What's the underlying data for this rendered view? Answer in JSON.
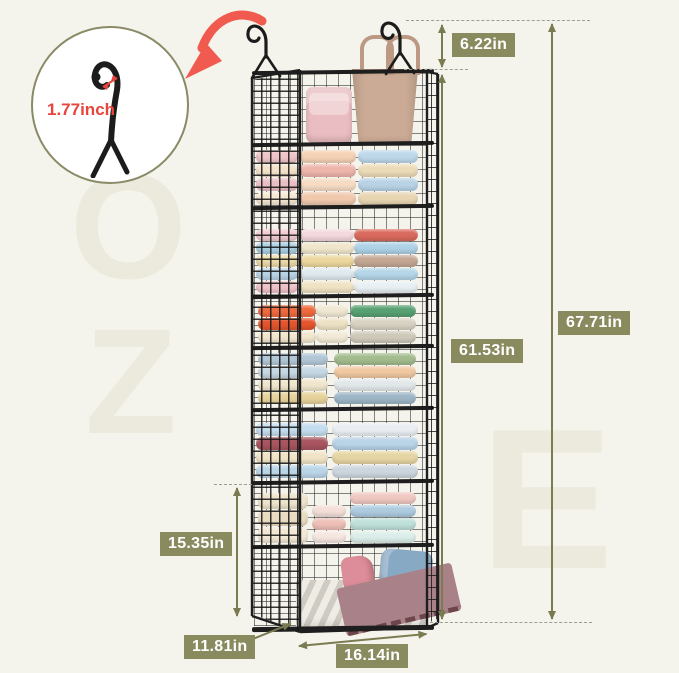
{
  "scene": {
    "background": "#f5f4ec"
  },
  "watermark": {
    "letters": [
      "O",
      "Z",
      "E"
    ]
  },
  "inset": {
    "label": "1.77inch",
    "label_color": "#e8453c",
    "circle_border": "#8a8a66",
    "icon": "hanging-hook"
  },
  "dimensions": {
    "badge_color": "#8a8a5f",
    "line_color": "#7b7b52",
    "dash_color": "#9d9d90",
    "hook_to_top": "6.22in",
    "shelving_height": "61.53in",
    "total_height": "67.71in",
    "lower_section_height": "15.35in",
    "depth": "11.81in",
    "width": "16.14in"
  },
  "callout": {
    "arrow_color": "#f15a4f"
  },
  "organizer": {
    "wire_color": "#1e1e1e",
    "hooks": [
      "hanging-hook-left",
      "hanging-hook-right"
    ],
    "top_items": [
      {
        "name": "pink-quilted-handbag",
        "color": "#e9bdc1"
      },
      {
        "name": "tan-tote-bag",
        "color": "#cbab95",
        "handle_color": "#bb9983"
      }
    ],
    "shelves": [
      {
        "contents": "folded-clothes",
        "bottom_y": 205,
        "stacks": [
          {
            "x": 2,
            "w": 42,
            "lh": 13,
            "layers": [
              "#efc5c8",
              "#f2e2c9",
              "#eabfc3",
              "#f5e8d2"
            ]
          },
          {
            "x": 46,
            "w": 56,
            "lh": 13,
            "layers": [
              "#f4d2b5",
              "#eeb5ab",
              "#f6dcc3",
              "#f0c9ad"
            ]
          },
          {
            "x": 104,
            "w": 60,
            "lh": 13,
            "layers": [
              "#bdd8ea",
              "#ecdbb8",
              "#b9d3e6",
              "#e8d6b2"
            ]
          }
        ]
      },
      {
        "contents": "folded-clothes",
        "bottom_y": 293,
        "stacks": [
          {
            "x": 2,
            "w": 42,
            "lh": 12,
            "layers": [
              "#f2ccd2",
              "#aacfe2",
              "#ecd9a8",
              "#b9d3e6",
              "#f0c3ca"
            ]
          },
          {
            "x": 46,
            "w": 54,
            "lh": 12,
            "layers": [
              "#f4d9dd",
              "#f0e6cc",
              "#ecd79e",
              "#dfe9ee",
              "#f0e2c4"
            ]
          },
          {
            "x": 100,
            "w": 64,
            "lh": 12,
            "layers": [
              "#da6a5e",
              "#aed2e6",
              "#c3a794",
              "#b4d6e8",
              "#e8f0f4"
            ]
          }
        ]
      },
      {
        "contents": "folded-clothes",
        "bottom_y": 343,
        "stacks": [
          {
            "x": 4,
            "w": 58,
            "lh": 12,
            "layers": [
              "#ef6a3e",
              "#e4552d",
              "#f2e6cd"
            ]
          },
          {
            "x": 62,
            "w": 32,
            "lh": 12,
            "layers": [
              "#f0e8d2",
              "#eee2c4",
              "#f2ead6"
            ]
          },
          {
            "x": 96,
            "w": 66,
            "lh": 12,
            "layers": [
              "#58a173",
              "#d8d2c2",
              "#cfc9ba"
            ]
          }
        ]
      },
      {
        "contents": "folded-clothes",
        "bottom_y": 404,
        "stacks": [
          {
            "x": 4,
            "w": 70,
            "lh": 12,
            "layers": [
              "#b2c7d6",
              "#c6d8e4",
              "#f0e6cc",
              "#e6d29a"
            ]
          },
          {
            "x": 80,
            "w": 82,
            "lh": 12,
            "layers": [
              "#a3bc8e",
              "#f0c8a2",
              "#e2e8ea",
              "#9db6c6"
            ]
          }
        ]
      },
      {
        "contents": "folded-clothes",
        "bottom_y": 478,
        "stacks": [
          {
            "x": 2,
            "w": 72,
            "lh": 13,
            "layers": [
              "#c3dcee",
              "#a85560",
              "#f0e3c6",
              "#bad5e8"
            ]
          },
          {
            "x": 78,
            "w": 86,
            "lh": 13,
            "layers": [
              "#e9eef3",
              "#b9d3e8",
              "#e6d5a4",
              "#ccd6de"
            ]
          }
        ]
      },
      {
        "contents": "knit-sweaters-and-clothes",
        "bottom_y": 543,
        "stacks": [
          {
            "x": 4,
            "w": 50,
            "lh": 16,
            "layers": [
              "#eee3cb",
              "#e9dcc0",
              "#f2e8d4"
            ]
          },
          {
            "x": 58,
            "w": 34,
            "lh": 12,
            "layers": [
              "#f4dfd8",
              "#eebfb7",
              "#f6e6e0"
            ]
          },
          {
            "x": 96,
            "w": 66,
            "lh": 12,
            "layers": [
              "#f0c8c2",
              "#aecbe0",
              "#bfe0da",
              "#dceee9"
            ]
          }
        ]
      }
    ],
    "bin": {
      "name": "chevron-storage-bin",
      "base_color": "#efece6",
      "stripe_color": "#cfcbc2",
      "items": [
        {
          "name": "pink-scarf",
          "color": "#dd8d99"
        },
        {
          "name": "denim-scarves",
          "color": "#87a9c4"
        },
        {
          "name": "plaid-throw",
          "color": "#a98289"
        }
      ]
    }
  }
}
